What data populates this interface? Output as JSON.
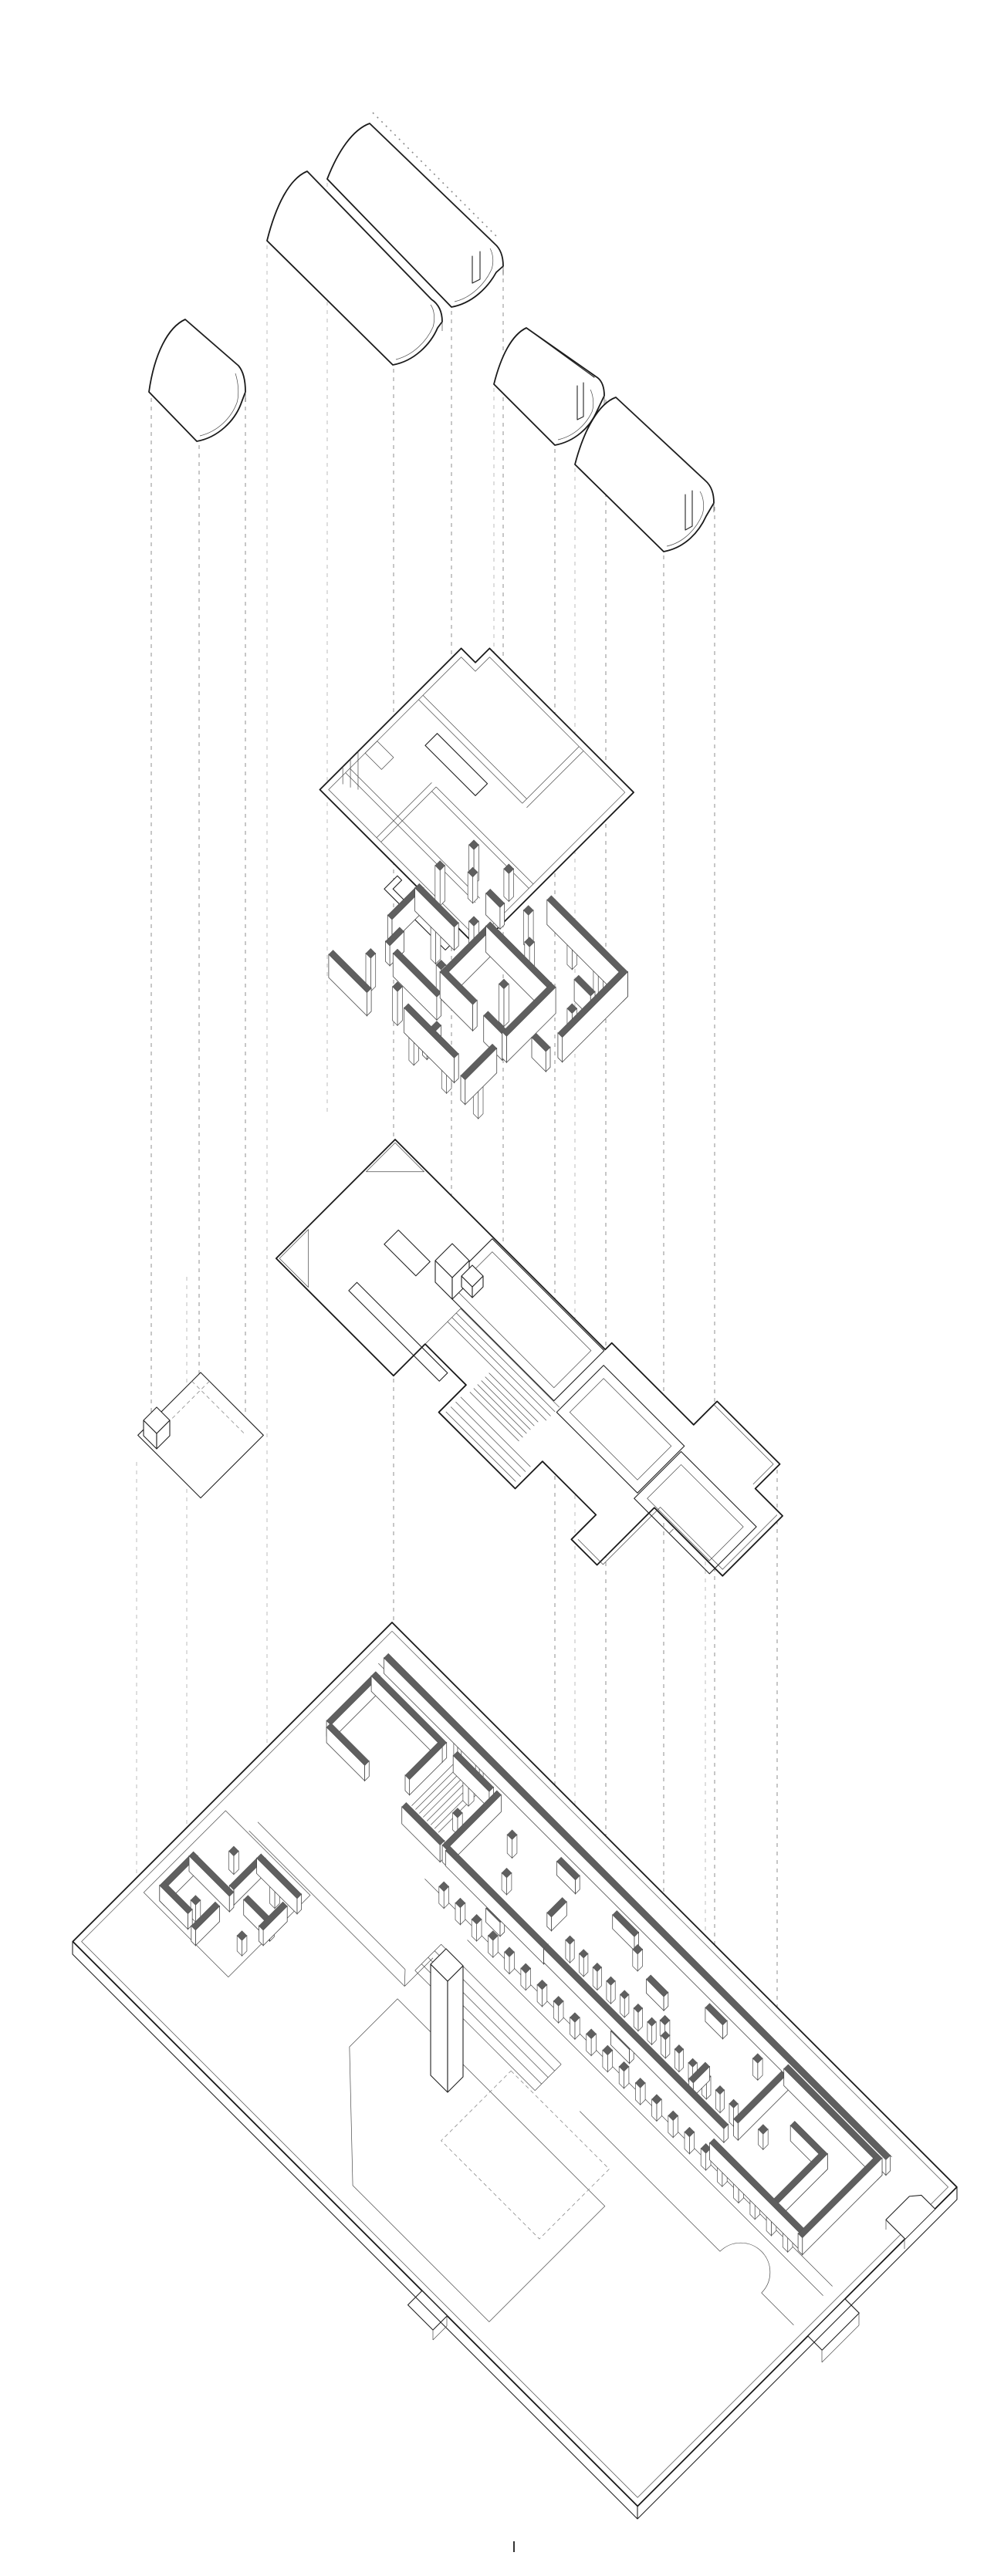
{
  "document": {
    "title": "Exploded axonometric architectural drawing",
    "projection": "plan oblique 45",
    "background": "#ffffff"
  },
  "colors": {
    "line": "#222222",
    "line_bold": "#1a1a1a",
    "line_thin": "#4a4a4a",
    "wall_fill": "#5f5f5f",
    "wall_fill_dark": "#555555",
    "dash": "#8f8f8f",
    "dash_faint": "#bdbdbd",
    "white": "#ffffff"
  },
  "layers": [
    {
      "id": "projection-lines",
      "label": "vertical projection guides"
    },
    {
      "id": "vaults",
      "label": "barrel vault roof shells",
      "count": 5
    },
    {
      "id": "roof-plan",
      "label": "roof plan"
    },
    {
      "id": "walls-level",
      "label": "upper level walls and columns"
    },
    {
      "id": "floor-plate",
      "label": "main floor plate with stair"
    },
    {
      "id": "annex-plate",
      "label": "small annex plate"
    },
    {
      "id": "site-plan",
      "label": "site plan base slab"
    }
  ],
  "marks": {
    "registration_tick": "|"
  }
}
